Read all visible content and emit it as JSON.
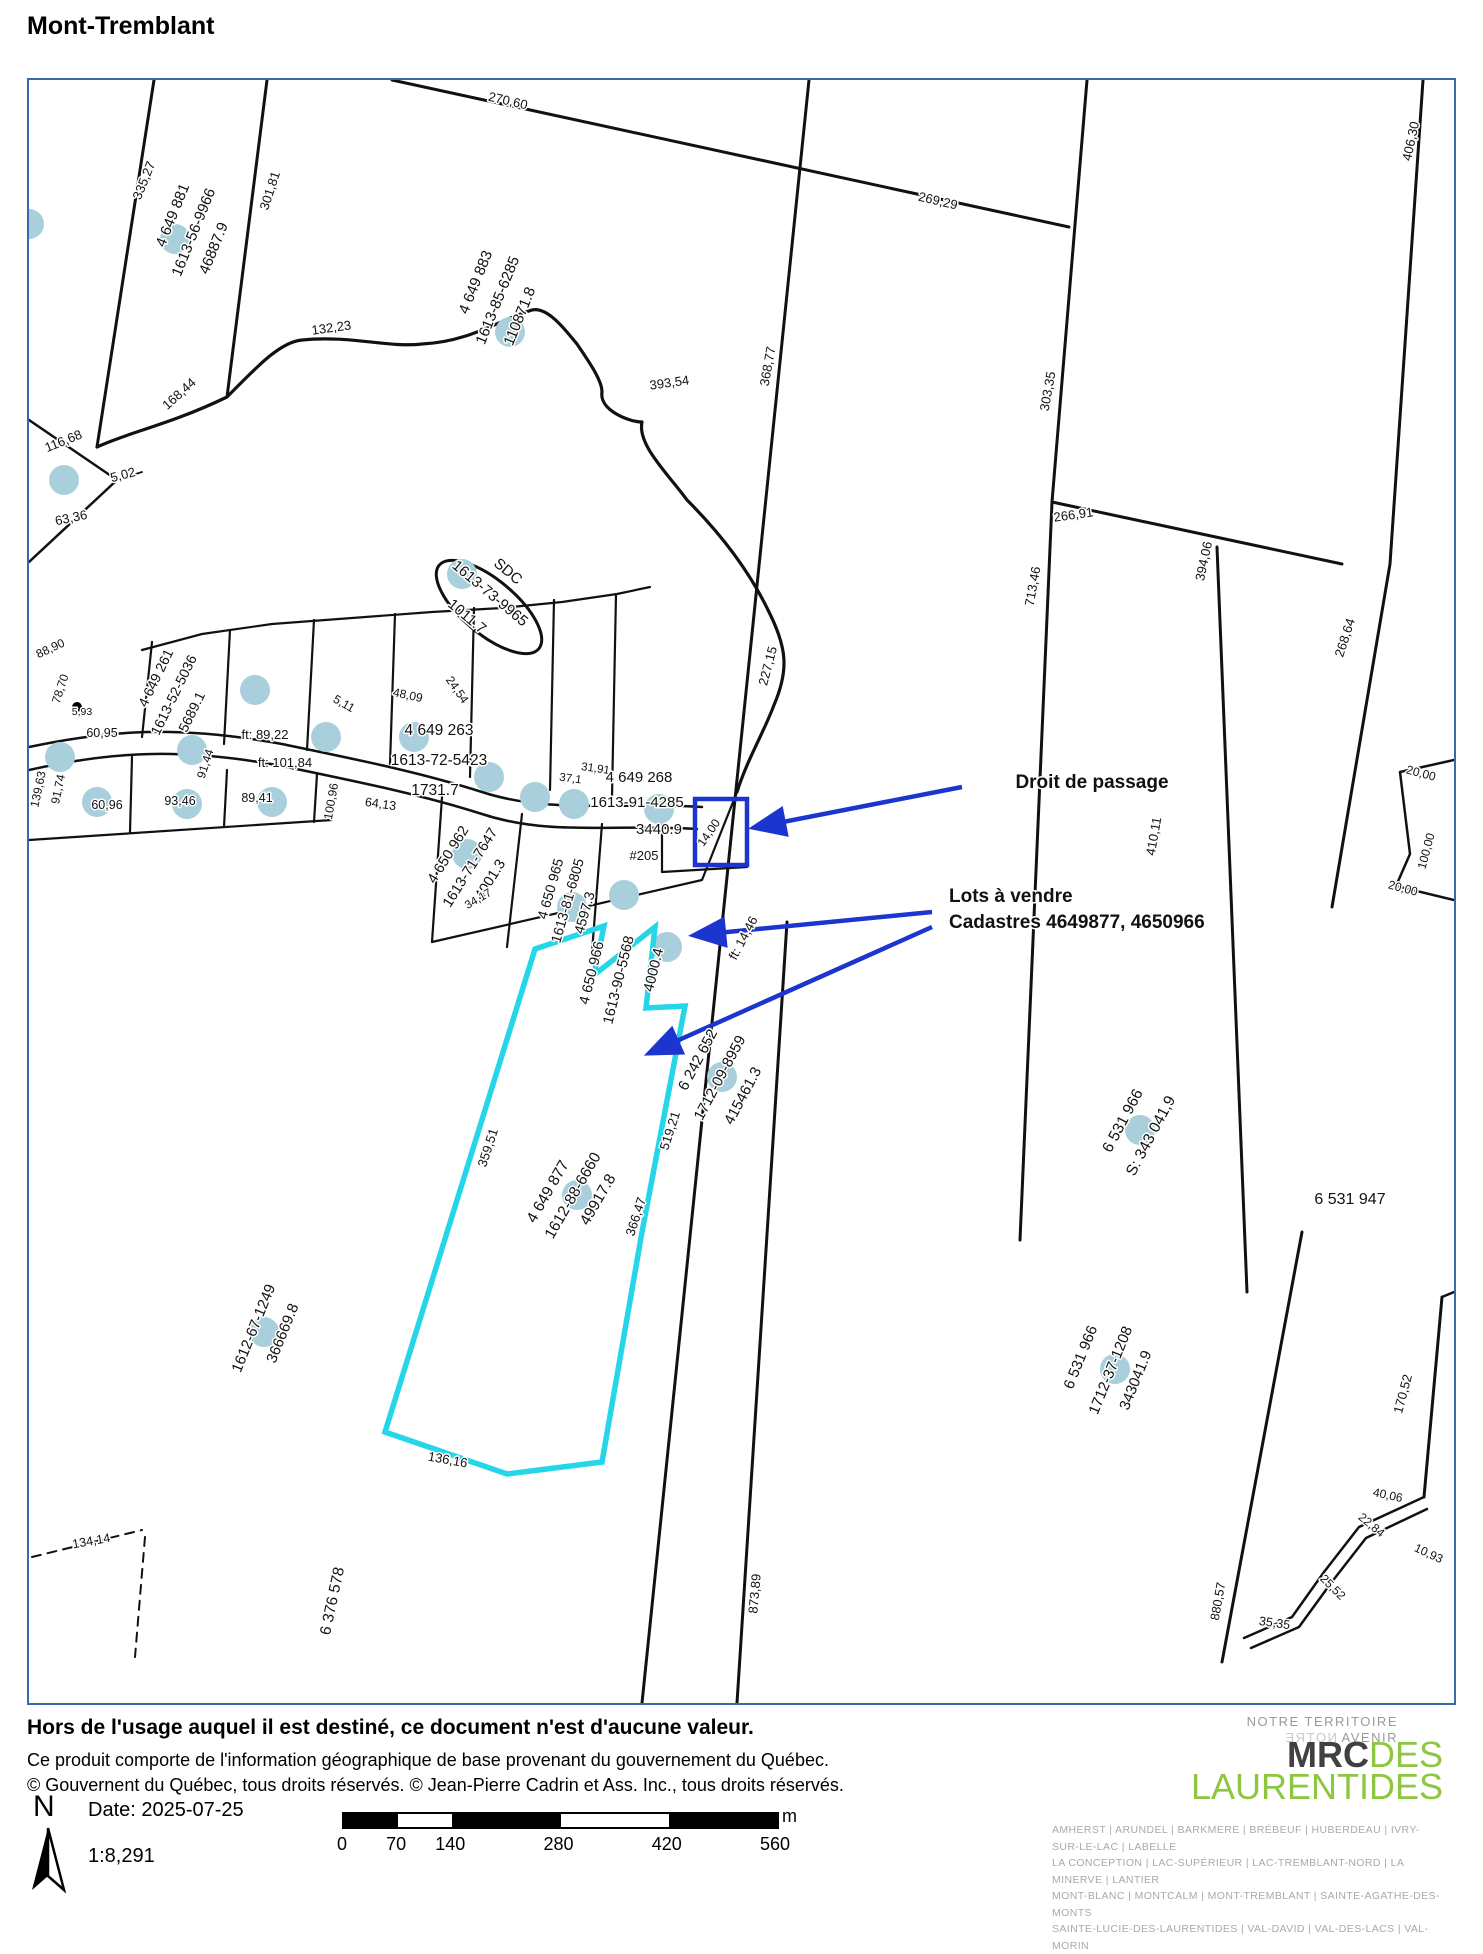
{
  "page": {
    "title": "Mont-Tremblant"
  },
  "map": {
    "highlight_color": "#25d6e9",
    "annotation_color": "#1c35cf",
    "marker_color": "#a9cfdc",
    "labels": [
      {
        "t": "335,27",
        "x": 119,
        "y": 102,
        "r": -68
      },
      {
        "t": "4 649 881",
        "x": 148,
        "y": 137,
        "r": -68,
        "s": 15
      },
      {
        "t": "1613-56-9966",
        "x": 169,
        "y": 154,
        "r": -68,
        "s": 15
      },
      {
        "t": "46887.9",
        "x": 189,
        "y": 170,
        "r": -68,
        "s": 15
      },
      {
        "t": "301,81",
        "x": 245,
        "y": 112,
        "r": -72
      },
      {
        "t": "270,60",
        "x": 478,
        "y": 25,
        "r": 13
      },
      {
        "t": "269,29",
        "x": 908,
        "y": 125,
        "r": 13
      },
      {
        "t": "4 649 883",
        "x": 451,
        "y": 204,
        "r": -68,
        "s": 15
      },
      {
        "t": "1613-85-6285",
        "x": 473,
        "y": 222,
        "r": -68,
        "s": 15
      },
      {
        "t": "110871.8",
        "x": 495,
        "y": 238,
        "r": -68,
        "s": 15
      },
      {
        "t": "132,23",
        "x": 303,
        "y": 252,
        "r": -8
      },
      {
        "t": "116,68",
        "x": 36,
        "y": 365,
        "r": -22
      },
      {
        "t": "168,44",
        "x": 153,
        "y": 317,
        "r": -42
      },
      {
        "t": "5,02",
        "x": 95,
        "y": 399,
        "r": -15
      },
      {
        "t": "63,36",
        "x": 43,
        "y": 442,
        "r": -12
      },
      {
        "t": "393,54",
        "x": 641,
        "y": 307,
        "r": -8
      },
      {
        "t": "368,77",
        "x": 743,
        "y": 287,
        "r": -80
      },
      {
        "t": "303,35",
        "x": 1023,
        "y": 312,
        "r": -80
      },
      {
        "t": "227,15",
        "x": 743,
        "y": 587,
        "r": -75
      },
      {
        "t": "266,91",
        "x": 1045,
        "y": 439,
        "r": -8
      },
      {
        "t": "406,30",
        "x": 1386,
        "y": 62,
        "r": -78
      },
      {
        "t": "713,46",
        "x": 1008,
        "y": 507,
        "r": -80
      },
      {
        "t": "394,06",
        "x": 1179,
        "y": 482,
        "r": -78
      },
      {
        "t": "268,64",
        "x": 1320,
        "y": 559,
        "r": -72
      },
      {
        "t": "410,11",
        "x": 1129,
        "y": 757,
        "r": -80
      },
      {
        "t": "SDC",
        "x": 476,
        "y": 495,
        "r": 40,
        "s": 15
      },
      {
        "t": "1613-73-9965",
        "x": 458,
        "y": 517,
        "r": 40,
        "s": 15
      },
      {
        "t": "1011.7",
        "x": 435,
        "y": 540,
        "r": 40,
        "s": 15
      },
      {
        "t": "4 649 261",
        "x": 131,
        "y": 600,
        "r": -64,
        "s": 14
      },
      {
        "t": "1613-52-5036",
        "x": 149,
        "y": 617,
        "r": -64,
        "s": 14
      },
      {
        "t": "5689.1",
        "x": 167,
        "y": 634,
        "r": -64,
        "s": 14
      },
      {
        "t": "4 649 263",
        "x": 410,
        "y": 655,
        "s": 15.5
      },
      {
        "t": "1613-72-5423",
        "x": 410,
        "y": 685,
        "s": 15.5
      },
      {
        "t": "1731.7",
        "x": 406,
        "y": 715,
        "s": 15.5
      },
      {
        "t": "ft: 101,84",
        "x": 256,
        "y": 687,
        "s": 13
      },
      {
        "t": "ft: 89,22",
        "x": 236,
        "y": 659,
        "s": 13
      },
      {
        "t": "60,95",
        "x": 73,
        "y": 657,
        "s": 12.5
      },
      {
        "t": "5,93",
        "x": 53,
        "y": 635,
        "s": 10.5
      },
      {
        "t": "88,90",
        "x": 23,
        "y": 572,
        "r": -25,
        "s": 12
      },
      {
        "t": "78,70",
        "x": 35,
        "y": 610,
        "r": -72,
        "s": 12
      },
      {
        "t": "139,63",
        "x": 13,
        "y": 710,
        "r": -78,
        "s": 12
      },
      {
        "t": "91,74",
        "x": 33,
        "y": 710,
        "r": -78,
        "s": 12
      },
      {
        "t": "60,96",
        "x": 78,
        "y": 729,
        "s": 12.5
      },
      {
        "t": "93,46",
        "x": 151,
        "y": 725,
        "s": 12.5
      },
      {
        "t": "89,41",
        "x": 228,
        "y": 722,
        "s": 12.5
      },
      {
        "t": "91,44",
        "x": 180,
        "y": 685,
        "r": -72,
        "s": 12
      },
      {
        "t": "5,11",
        "x": 313,
        "y": 627,
        "r": 30,
        "s": 12
      },
      {
        "t": "48,09",
        "x": 378,
        "y": 619,
        "r": 12,
        "s": 12
      },
      {
        "t": "24,54",
        "x": 425,
        "y": 612,
        "r": 55,
        "s": 12
      },
      {
        "t": "31,91",
        "x": 566,
        "y": 692,
        "r": 8,
        "s": 11.5
      },
      {
        "t": "37,1",
        "x": 541,
        "y": 702,
        "r": 8,
        "s": 11.5
      },
      {
        "t": "100,96",
        "x": 306,
        "y": 722,
        "r": -80,
        "s": 12
      },
      {
        "t": "64,13",
        "x": 351,
        "y": 728,
        "r": 8,
        "s": 12.5
      },
      {
        "t": "4 649 268",
        "x": 610,
        "y": 702,
        "s": 15
      },
      {
        "t": "1613-91-4285",
        "x": 608,
        "y": 727,
        "s": 15
      },
      {
        "t": "3440.9",
        "x": 630,
        "y": 754,
        "s": 15
      },
      {
        "t": "14,00",
        "x": 683,
        "y": 755,
        "r": -55,
        "s": 12
      },
      {
        "t": "#205",
        "x": 615,
        "y": 780,
        "s": 13
      },
      {
        "t": "4 650 962",
        "x": 423,
        "y": 777,
        "r": -58,
        "s": 14.5
      },
      {
        "t": "1613-71-7647",
        "x": 445,
        "y": 790,
        "r": -58,
        "s": 14.5
      },
      {
        "t": "4001.3",
        "x": 465,
        "y": 802,
        "r": -58,
        "s": 14.5
      },
      {
        "t": "34,17",
        "x": 451,
        "y": 822,
        "r": -30,
        "s": 11.5
      },
      {
        "t": "4 650 965",
        "x": 526,
        "y": 810,
        "r": -74,
        "s": 14
      },
      {
        "t": "1613-81-6805",
        "x": 543,
        "y": 822,
        "r": -74,
        "s": 14
      },
      {
        "t": "4597.3",
        "x": 560,
        "y": 834,
        "r": -74,
        "s": 14
      },
      {
        "t": "4 650 966",
        "x": 567,
        "y": 894,
        "r": -76,
        "s": 14.5
      },
      {
        "t": "1613-90-5568",
        "x": 594,
        "y": 901,
        "r": -76,
        "s": 14.5
      },
      {
        "t": "4000.4",
        "x": 629,
        "y": 891,
        "r": -76,
        "s": 14.5
      },
      {
        "t": "ft: 14,46",
        "x": 718,
        "y": 860,
        "r": -62,
        "s": 13
      },
      {
        "t": "6 242 652",
        "x": 673,
        "y": 982,
        "r": -62,
        "s": 15
      },
      {
        "t": "1712-09-8959",
        "x": 695,
        "y": 1000,
        "r": -62,
        "s": 15
      },
      {
        "t": "415461.3",
        "x": 718,
        "y": 1018,
        "r": -62,
        "s": 15
      },
      {
        "t": "4 649 877",
        "x": 523,
        "y": 1114,
        "r": -60,
        "s": 15.5
      },
      {
        "t": "1612-88-6660",
        "x": 548,
        "y": 1118,
        "r": -60,
        "s": 15.5
      },
      {
        "t": "49917.8",
        "x": 573,
        "y": 1122,
        "r": -60,
        "s": 15.5
      },
      {
        "t": "359,51",
        "x": 463,
        "y": 1069,
        "r": -72,
        "s": 13
      },
      {
        "t": "519,21",
        "x": 645,
        "y": 1052,
        "r": -72,
        "s": 13
      },
      {
        "t": "366,47",
        "x": 611,
        "y": 1138,
        "r": -72,
        "s": 13
      },
      {
        "t": "136,16",
        "x": 418,
        "y": 1384,
        "r": 10,
        "s": 13
      },
      {
        "t": "6 531 966",
        "x": 1098,
        "y": 1043,
        "r": -62,
        "s": 15.5
      },
      {
        "t": "S: 343 041,9",
        "x": 1126,
        "y": 1058,
        "r": -62,
        "s": 15.5
      },
      {
        "t": "6 531 947",
        "x": 1321,
        "y": 1124,
        "s": 16
      },
      {
        "t": "6 531 966",
        "x": 1056,
        "y": 1279,
        "r": -68,
        "s": 15
      },
      {
        "t": "1712-37-1208",
        "x": 1086,
        "y": 1292,
        "r": -68,
        "s": 15
      },
      {
        "t": "343041.9",
        "x": 1111,
        "y": 1302,
        "r": -68,
        "s": 15
      },
      {
        "t": "170,52",
        "x": 1378,
        "y": 1315,
        "r": -75,
        "s": 13
      },
      {
        "t": "873,89",
        "x": 730,
        "y": 1514,
        "r": -85,
        "s": 13
      },
      {
        "t": "880,57",
        "x": 1193,
        "y": 1522,
        "r": -80,
        "s": 12.5
      },
      {
        "t": "35,35",
        "x": 1245,
        "y": 1547,
        "r": 8,
        "s": 12.5
      },
      {
        "t": "25,52",
        "x": 1301,
        "y": 1510,
        "r": 45,
        "s": 12
      },
      {
        "t": "40,06",
        "x": 1358,
        "y": 1419,
        "r": 12,
        "s": 12
      },
      {
        "t": "22,84",
        "x": 1340,
        "y": 1448,
        "r": 40,
        "s": 12
      },
      {
        "t": "10,93",
        "x": 1398,
        "y": 1477,
        "r": 25,
        "s": 12
      },
      {
        "t": "1612-67-1249",
        "x": 229,
        "y": 1250,
        "r": -68,
        "s": 15
      },
      {
        "t": "366669.8",
        "x": 258,
        "y": 1255,
        "r": -68,
        "s": 15
      },
      {
        "t": "6 376 578",
        "x": 308,
        "y": 1522,
        "r": -78,
        "s": 15.5
      },
      {
        "t": "134,14",
        "x": 63,
        "y": 1465,
        "r": -10,
        "s": 12.5
      },
      {
        "t": "20,00",
        "x": 1391,
        "y": 697,
        "r": 15,
        "s": 12
      },
      {
        "t": "100,00",
        "x": 1401,
        "y": 772,
        "r": -75,
        "s": 12
      },
      {
        "t": "20,00",
        "x": 1373,
        "y": 812,
        "r": 15,
        "s": 12
      },
      {
        "t": "Droit de passage",
        "x": 1063,
        "y": 708,
        "s": 19,
        "b": 1
      },
      {
        "t": "Lots à vendre",
        "x": 920,
        "y": 822,
        "s": 19,
        "b": 1,
        "a": "start"
      },
      {
        "t": "Cadastres 4649877, 4650966",
        "x": 920,
        "y": 848,
        "s": 19,
        "b": 1,
        "a": "start"
      }
    ],
    "point_markers": [
      [
        0,
        144
      ],
      [
        146,
        159
      ],
      [
        481,
        252
      ],
      [
        433,
        494
      ],
      [
        35,
        400
      ],
      [
        31,
        677
      ],
      [
        163,
        670
      ],
      [
        226,
        610
      ],
      [
        297,
        657
      ],
      [
        385,
        657
      ],
      [
        460,
        697
      ],
      [
        68,
        722
      ],
      [
        158,
        724
      ],
      [
        243,
        722
      ],
      [
        506,
        717
      ],
      [
        545,
        724
      ],
      [
        630,
        729
      ],
      [
        595,
        815
      ],
      [
        438,
        774
      ],
      [
        543,
        827
      ],
      [
        638,
        867
      ],
      [
        693,
        997
      ],
      [
        548,
        1115
      ],
      [
        235,
        1252
      ],
      [
        1111,
        1050
      ],
      [
        1086,
        1289
      ]
    ]
  },
  "footer": {
    "disclaimer": {
      "line1": "Hors de l'usage auquel il est destiné, ce document n'est d'aucune valeur.",
      "line2": "Ce produit comporte de l'information géographique de base provenant du gouvernement du Québec.",
      "line3": "© Gouvernent du Québec, tous droits réservés. © Jean-Pierre Cadrin et Ass. Inc., tous droits réservés."
    },
    "north_label": "N",
    "date_label": "Date: 2025-07-25",
    "scale_ratio": "1:8,291",
    "scale_bar": {
      "ticks": [
        "0",
        "70",
        "140",
        "280",
        "420",
        "560"
      ],
      "unit": "m"
    },
    "logo": {
      "tagline1": "NOTRE TERRITOIRE",
      "tagline2_mirrored": "NOTRE",
      "tagline2_rest": " AVENIR",
      "brand_bold": "MRC",
      "brand_light": "DES",
      "brand_line2": "LAURENTIDES",
      "municipalities": [
        "AMHERST | ARUNDEL | BARKMERE | BRÉBEUF | HUBERDEAU | IVRY-SUR-LE-LAC | LABELLE",
        "LA CONCEPTION | LAC-SUPÉRIEUR | LAC-TREMBLANT-NORD | LA MINERVE | LANTIER",
        "MONT-BLANC | MONTCALM | MONT-TREMBLANT | SAINTE-AGATHE-DES-MONTS",
        "SAINTE-LUCIE-DES-LAURENTIDES | VAL-DAVID | VAL-DES-LACS | VAL-MORIN"
      ]
    }
  }
}
